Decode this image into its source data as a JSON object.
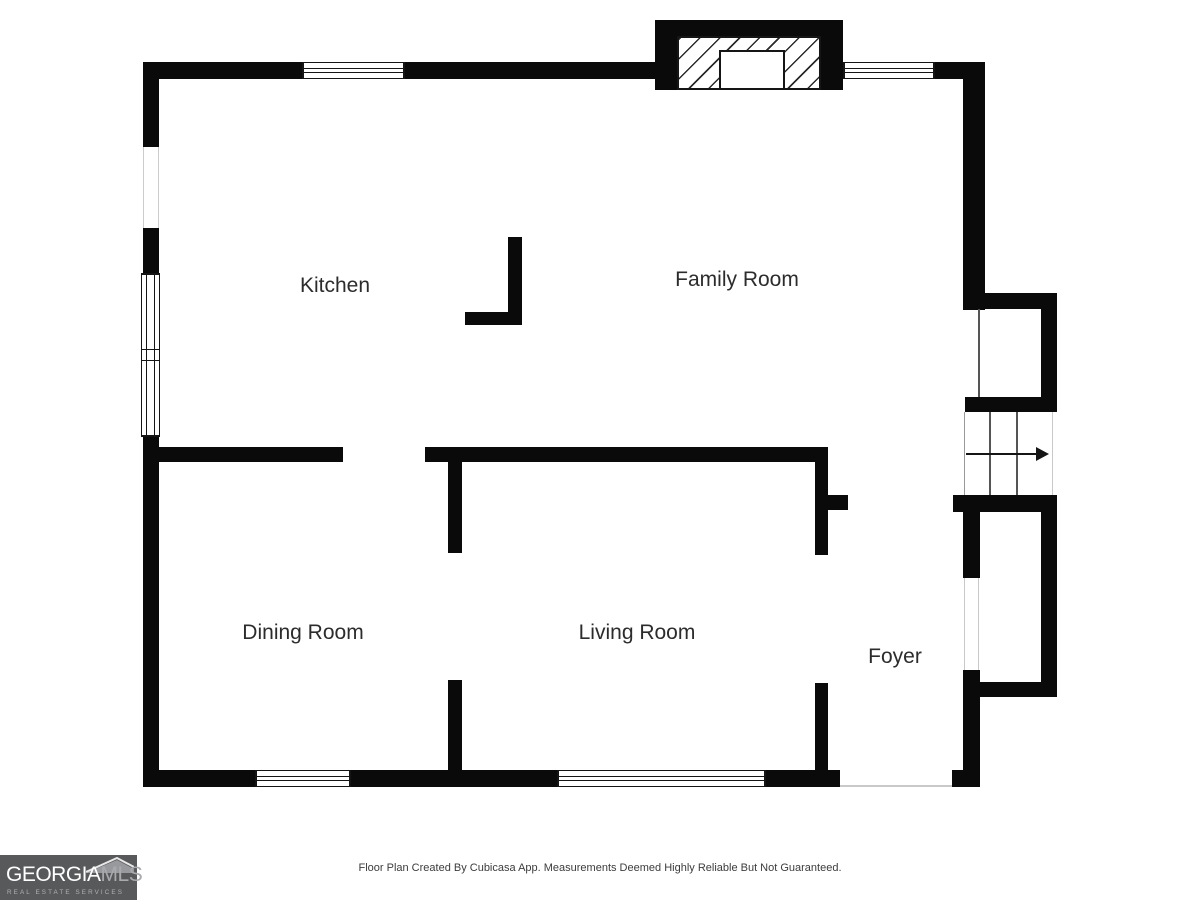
{
  "plan": {
    "rooms": [
      {
        "id": "kitchen",
        "label": "Kitchen"
      },
      {
        "id": "family-room",
        "label": "Family Room"
      },
      {
        "id": "dining-room",
        "label": "Dining Room"
      },
      {
        "id": "living-room",
        "label": "Living Room"
      },
      {
        "id": "foyer",
        "label": "Foyer"
      }
    ],
    "stairs": {
      "direction": "right",
      "tread_lines": 2
    },
    "features": [
      "fireplace",
      "bay-window",
      "entry-opening"
    ]
  },
  "footer": {
    "disclaimer": "Floor Plan Created By Cubicasa App. Measurements Deemed Highly Reliable But Not Guaranteed."
  },
  "logo": {
    "name": "GEORGIA",
    "suffix": "MLS",
    "tagline": "REAL ESTATE SERVICES"
  },
  "colors": {
    "wall": "#0a0a0a",
    "bg": "#ffffff",
    "label": "#2c2c2c",
    "logo-bg": "#58595b",
    "logo-primary": "#ffffff",
    "logo-secondary": "#a8aaad"
  }
}
